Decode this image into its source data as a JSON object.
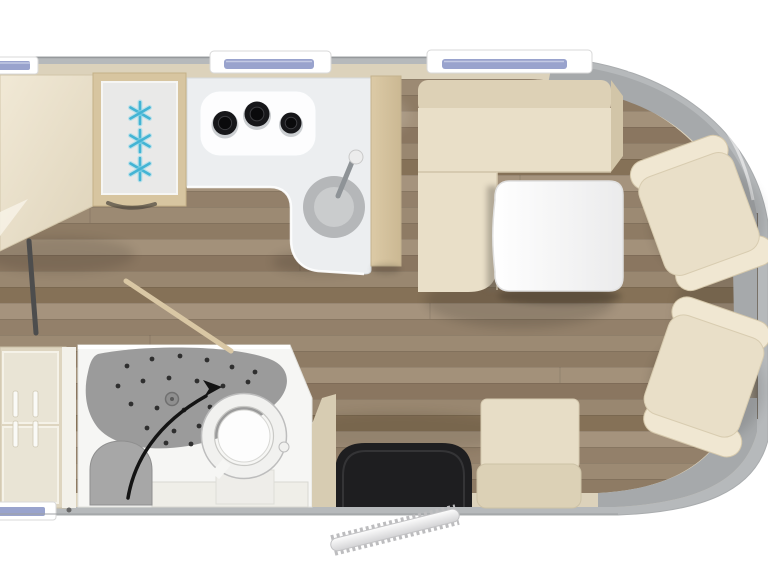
{
  "scene": {
    "subject": "motorhome-floor-plan-top-view",
    "vehicle_front": "right",
    "rooms": [
      "bed-area",
      "kitchen",
      "bathroom",
      "dinette",
      "cab"
    ]
  },
  "colors": {
    "exterior": "#ffffff",
    "body_gray": "#b6b9bb",
    "body_edge": "#999da0",
    "wall_beige": "#dcd2bb",
    "wedge_beige": "#d7ccb2",
    "cab_gray": "#a6a9ab",
    "dark_edge": "#82796d",
    "bed_cream": "#ece3cd",
    "upholstery_cream": "#e9dfc8",
    "upholstery_light": "#f0e7d2",
    "upholstery_shade": "#ddd1b6",
    "bench_seat": "#e7ddc6",
    "bench_back": "#dcd1b6",
    "counter_white": "#eceef0",
    "hob_white": "#fdfdfe",
    "burner_black": "#17171a",
    "sink_gray": "#b5b7b9",
    "sink_inner": "#cacccd",
    "faucet_gray": "#8e9397",
    "fridge_frame_tan": "#d7c5a0",
    "fridge_panel": "#e9e9e8",
    "snowflake_blue": "#43b4d4",
    "column_tan": "#d5c29c",
    "table_white": "#fafafb",
    "mat_black": "#1e1e20",
    "bathroom_white": "#f6f6f4",
    "shower_gray": "#9b9b9b",
    "shower_dot": "#2f2f2f",
    "stool_gray": "#a7a7a7",
    "toilet_ring": "#f1f1ef",
    "toilet_outline": "#bdbdbd",
    "toilet_bowl": "#fdfdfd",
    "shelf_white": "#efeee8",
    "wardrobe_beige": "#ded5c0",
    "wardrobe_panel": "#e9e4d5",
    "handle_white": "#fafaf7",
    "window_frame": "#ffffff",
    "window_glass_blue": "#99a3cd",
    "arrow_black": "#141414",
    "door_rod_tan": "#d9c7a4",
    "step_silver": "#ececed",
    "ladder_gray": "#4d4d4d"
  },
  "floor": {
    "plank_height": 16,
    "top": 79,
    "bottom": 494,
    "plank_colors": [
      "#9c8a73",
      "#8e7b64",
      "#a3917a",
      "#8a7660",
      "#998770",
      "#857157",
      "#a5937d",
      "#93806a"
    ]
  },
  "kitchen": {
    "burners": [
      {
        "cx": 225,
        "cy": 123,
        "r": 12
      },
      {
        "cx": 257,
        "cy": 114,
        "r": 12.5
      },
      {
        "cx": 291,
        "cy": 123,
        "r": 10.5
      }
    ],
    "sink": {
      "cx": 334,
      "cy": 207,
      "r": 31
    }
  },
  "fridge": {
    "snowflake_count": 3,
    "snowflake_arm": 11,
    "snowflake_centers": [
      [
        140,
        113
      ],
      [
        140,
        141
      ],
      [
        140,
        169
      ]
    ]
  },
  "bathroom": {
    "drain": {
      "cx": 172,
      "cy": 399,
      "r": 6.5
    },
    "shower_dots": [
      [
        127,
        366
      ],
      [
        152,
        359
      ],
      [
        180,
        356
      ],
      [
        207,
        360
      ],
      [
        232,
        367
      ],
      [
        255,
        372
      ],
      [
        118,
        386
      ],
      [
        143,
        381
      ],
      [
        169,
        378
      ],
      [
        197,
        381
      ],
      [
        223,
        386
      ],
      [
        248,
        382
      ],
      [
        131,
        404
      ],
      [
        157,
        408
      ],
      [
        184,
        410
      ],
      [
        210,
        407
      ],
      [
        234,
        399
      ],
      [
        147,
        428
      ],
      [
        174,
        431
      ],
      [
        199,
        426
      ],
      [
        166,
        443
      ],
      [
        191,
        444
      ]
    ]
  },
  "furniture_labels": {
    "bed": "fixed-bed",
    "fridge": "freezer-refrigerator",
    "hob": "three-burner-hob",
    "sink": "round-kitchen-sink",
    "dinette": "l-shaped-dinette-bench",
    "table": "dining-table",
    "swivel_seat_count": 2,
    "side_bench": "entry-side-bench",
    "entry_mat": "entry-mat",
    "wardrobe": "wardrobe-drawers",
    "shower": "shower-tray",
    "toilet": "swivel-toilet",
    "window_count": 4
  }
}
